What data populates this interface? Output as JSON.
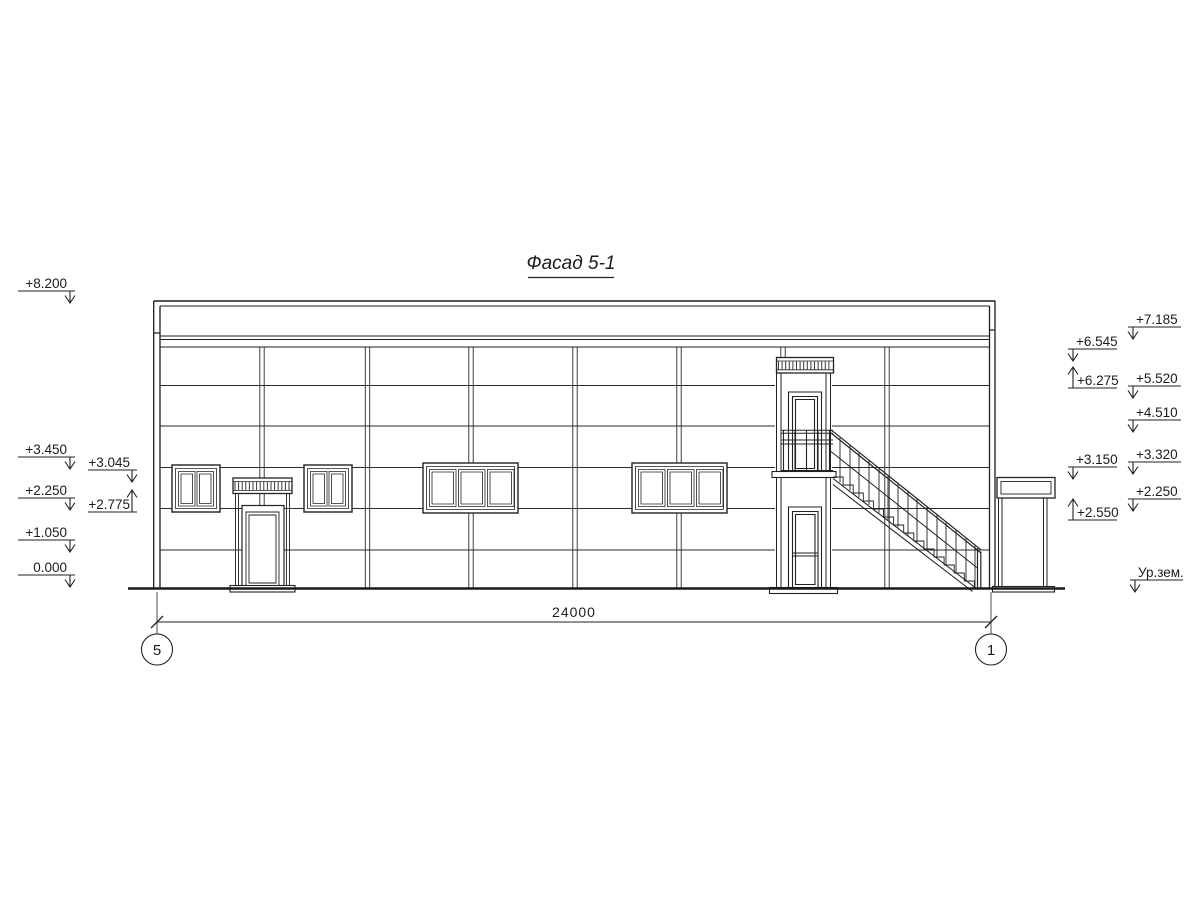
{
  "drawing": {
    "title": "Фасад 5-1",
    "dimension_total": "24000",
    "grid_axes": {
      "left": "5",
      "right": "1"
    },
    "levels_left_outer": [
      "+8.200",
      "+3.450",
      "+2.250",
      "+1.050",
      "0.000"
    ],
    "levels_left_inner": [
      "+3.045",
      "+2.775"
    ],
    "levels_right_inner": [
      "+6.545",
      "+6.275",
      "+3.150",
      "+2.550"
    ],
    "levels_right_outer": [
      "+7.185",
      "+5.520",
      "+4.510",
      "+3.320",
      "+2.250"
    ],
    "ground_level_label": "Ур.зем.",
    "colors": {
      "line": "#222222",
      "background": "#ffffff"
    }
  }
}
